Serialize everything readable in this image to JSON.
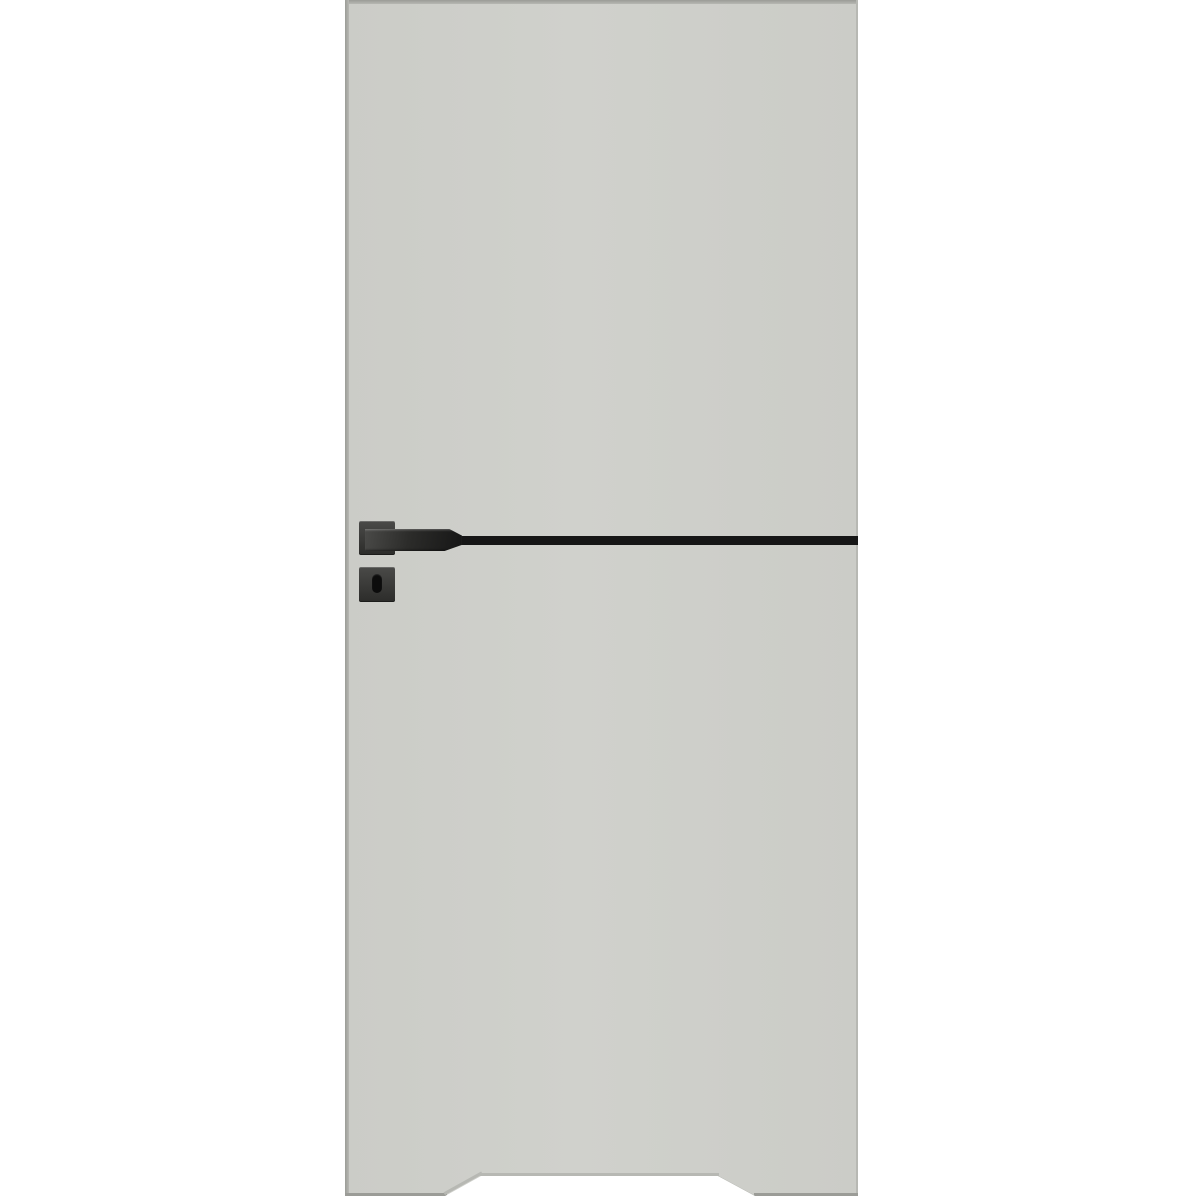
{
  "image": {
    "type": "product-photo",
    "subject": "interior-door-leaf",
    "visible_parts": [
      "door-leaf",
      "door-handle-lever",
      "handle-rosette",
      "keyhole-escutcheon",
      "keyhole-slot",
      "horizontal-inlay-stripe",
      "bottom-undercut-notch"
    ],
    "text_content": ""
  },
  "colors": {
    "background": "#ffffff",
    "door-face": "#cbccc7",
    "door-face-light": "#d0d1cc",
    "door-edge-dark": "#9b9c97",
    "door-edge-mid": "#b7b8b3",
    "stripe-black": "#161616",
    "hardware-dark": "#2c2c2a",
    "hardware-mid": "#4a4a48",
    "keyhole-black": "#0c0c0c"
  }
}
